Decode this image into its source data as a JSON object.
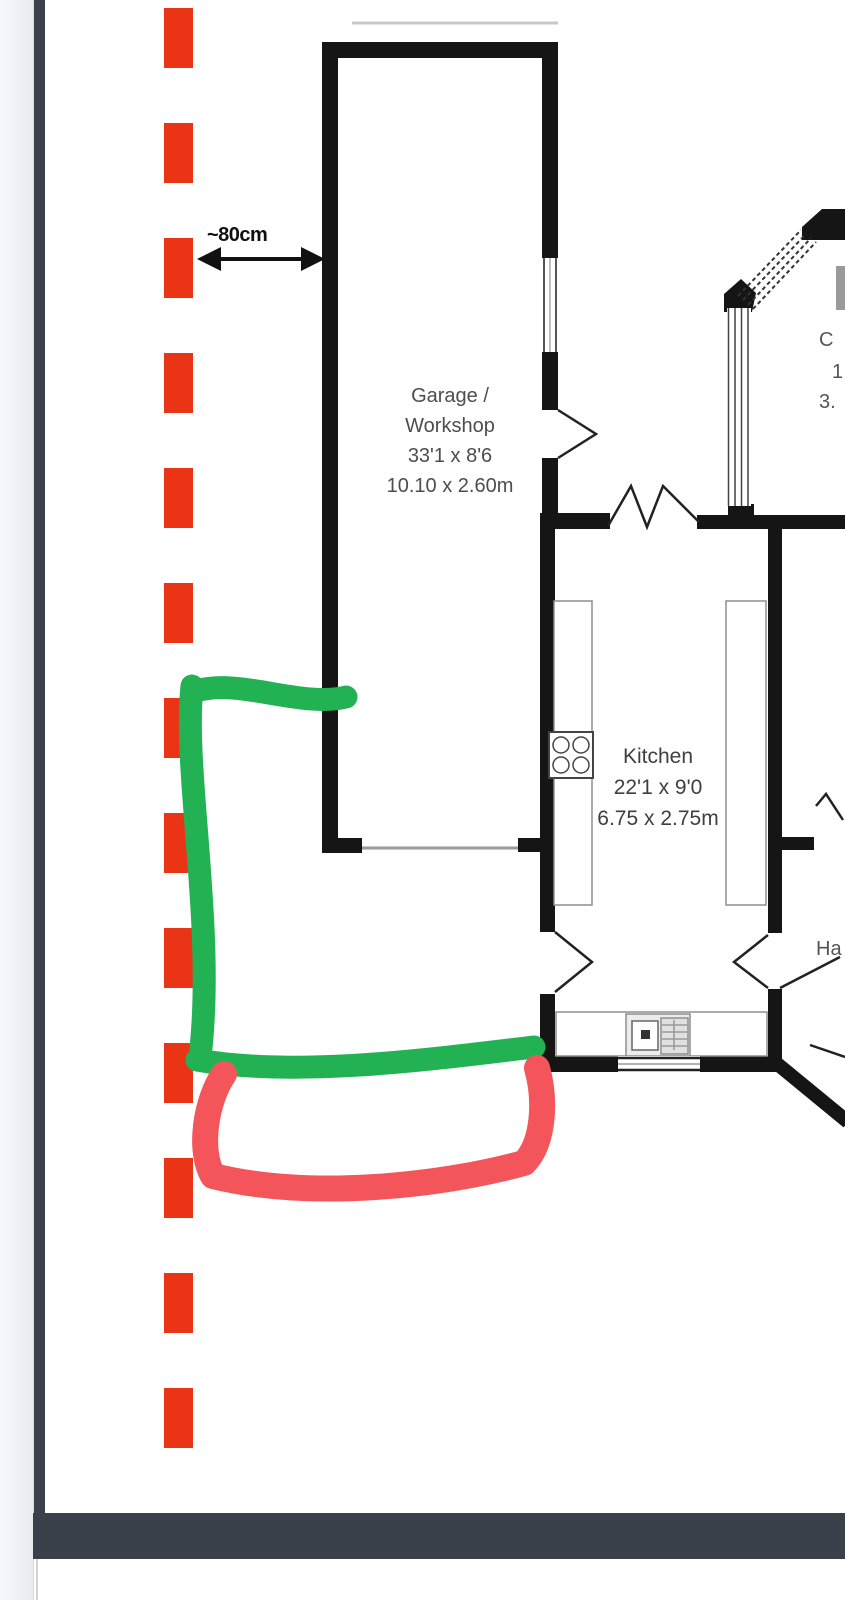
{
  "measurement": {
    "label": "~80cm"
  },
  "garage": {
    "name_line1": "Garage /",
    "name_line2": "Workshop",
    "dims_imperial": "33'1 x 8'6",
    "dims_metric": "10.10 x 2.60m"
  },
  "kitchen": {
    "name": "Kitchen",
    "dims_imperial": "22'1 x 9'0",
    "dims_metric": "6.75 x 2.75m"
  },
  "partial_right_room": {
    "line1": "C",
    "line2": "1",
    "line3": "3."
  },
  "partial_hall": {
    "label": "Ha"
  },
  "colors": {
    "boundary_red": "#e93515",
    "marker_green": "#22b254",
    "marker_red": "#f4555a",
    "wall_black": "#151515",
    "bar_slate": "#3b414b"
  }
}
